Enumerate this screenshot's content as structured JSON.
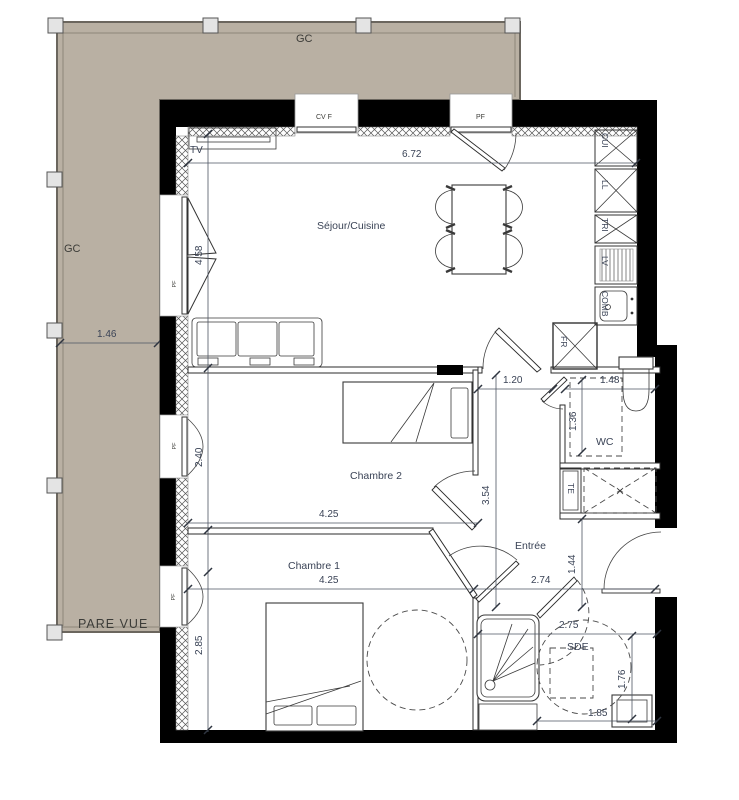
{
  "terrace": {
    "label_top": "GC",
    "label_left": "GC",
    "label_bottom": "PARE VUE"
  },
  "rooms": {
    "living": "Séjour/Cuisine",
    "bedroom2": "Chambre 2",
    "bedroom1": "Chambre 1",
    "entry": "Entrée",
    "wc": "WC",
    "shower_room": "SDE"
  },
  "openings": {
    "cvf": "CV F",
    "pf_top": "PF",
    "pf_living": "PF",
    "pf_bedroom2": "PF",
    "pf_bedroom1": "PF"
  },
  "equipment": {
    "tv": "TV",
    "kitchen_cui": "CUI",
    "kitchen_ll": "LL",
    "kitchen_tri": "TRI",
    "kitchen_lv": "LV",
    "kitchen_comb": "COMB",
    "fridge": "FR",
    "water_heater": "TE"
  },
  "dims": {
    "terrace_width": "1.46",
    "living_width": "6.72",
    "living_depth": "4.58",
    "bedroom2_depth": "2.40",
    "bedroom2_width": "4.25",
    "bedroom1_depth": "2.85",
    "bedroom1_width": "4.25",
    "hall_depth": "3.54",
    "hall_pass": "1.20",
    "wc_width": "1.48",
    "wc_depth": "1.36",
    "entry_width": "2.74",
    "entry_depth": "1.44",
    "shower_width": "2.75",
    "shower_depth": "1.76",
    "shower_bottom": "1.85"
  },
  "colors": {
    "terrace_fill": "#b9b0a3",
    "wall": "#000000",
    "annotation": "#3a4356",
    "background": "#ffffff"
  }
}
